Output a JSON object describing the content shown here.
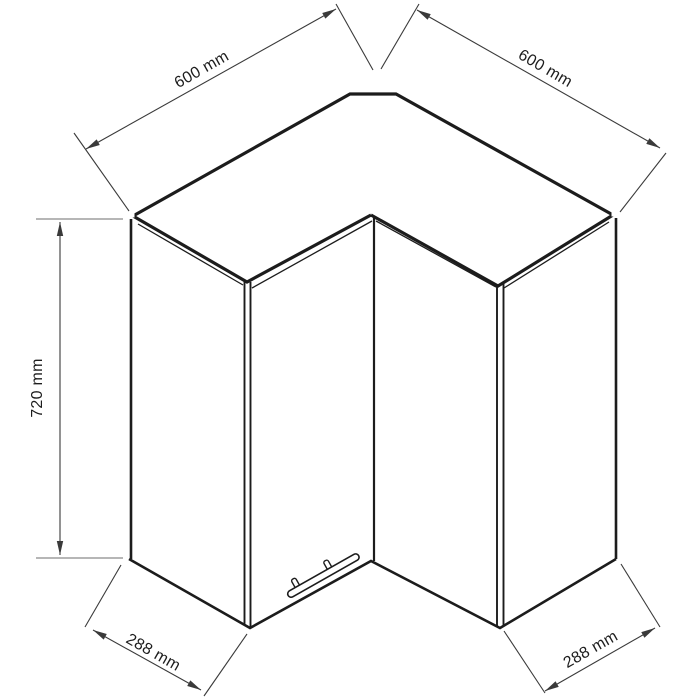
{
  "diagram": {
    "kind": "isometric line drawing",
    "subject": "corner wall cabinet with two doors and bar handle",
    "dimension_labels": {
      "top_left": "600 mm",
      "top_right": "600 mm",
      "left_height": "720 mm",
      "bottom_left": "288 mm",
      "bottom_right": "288 mm"
    },
    "dimensions_mm": {
      "wall_side_left": 600,
      "wall_side_right": 600,
      "height": 720,
      "end_panel_left": 288,
      "end_panel_right": 288
    },
    "colors": {
      "background": "#ffffff",
      "line": "#1c1c1c",
      "dimension": "#3a3a3a",
      "tick": "#8a8a8a",
      "text": "#1d1d1d"
    }
  }
}
